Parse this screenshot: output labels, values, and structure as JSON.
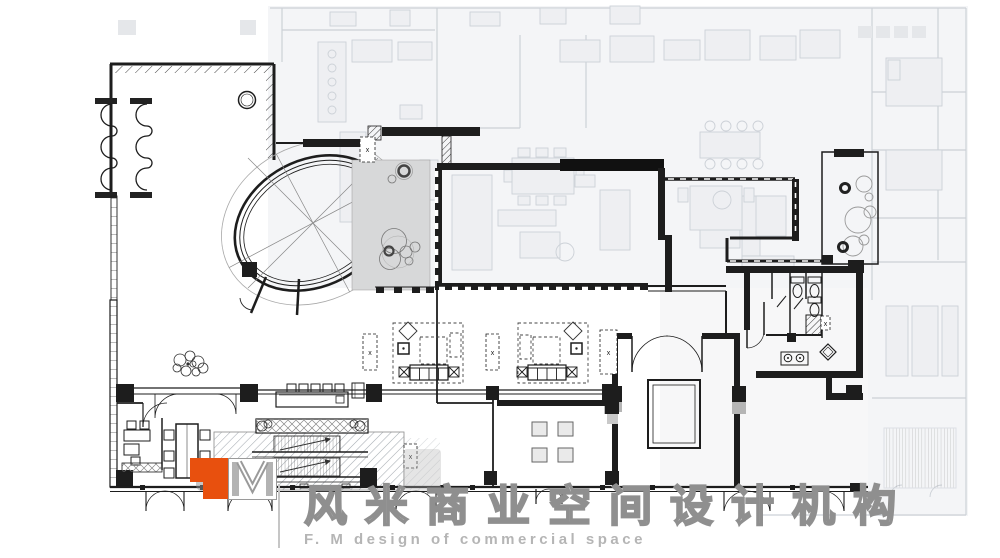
{
  "logo": {
    "cn_name": "风米商业空间设计机构",
    "en_name": "F. M design of commercial space",
    "monogram": "M",
    "orange": "#E8500E",
    "text_gray": "#ABABAB"
  },
  "plan": {
    "column_marker": "x",
    "colors": {
      "paper": "#FFFFFF",
      "wall": "#1D1D1D",
      "underlay_line": "#C7CCD3",
      "underlay_fill": "#F2F3F5",
      "panel_gray": "#D7D8D9",
      "hatch_line": "#949BA3"
    }
  }
}
